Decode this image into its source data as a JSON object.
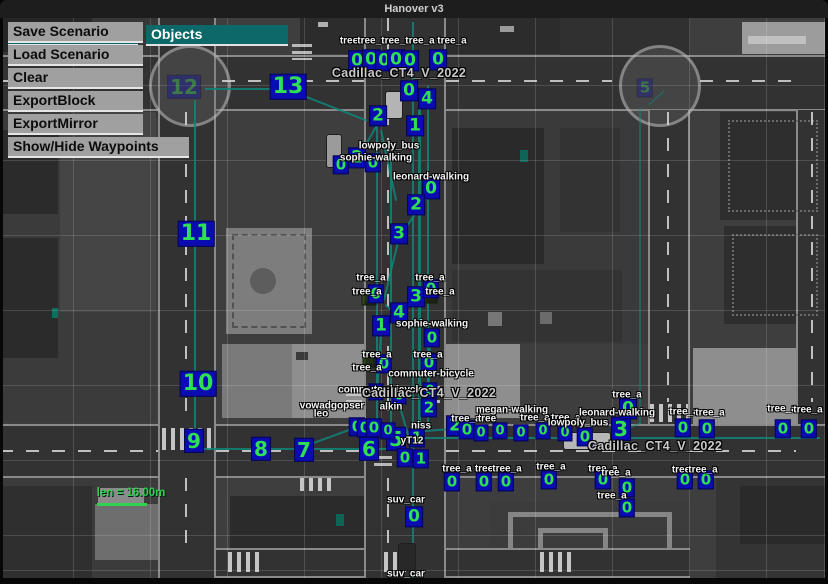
{
  "window": {
    "title": "Hanover v3"
  },
  "menu": {
    "file_label": "File",
    "objects_label": "Objects",
    "items": [
      "Save Scenario",
      "Load Scenario",
      "Clear",
      "ExportBlock",
      "ExportMirror",
      "Show/Hide Waypoints"
    ]
  },
  "hud": {
    "length_label": "len = 16.00m"
  },
  "colors": {
    "accent_teal": "#0d6969",
    "waypoint_green": "#2fe052",
    "waypoint_box_blue": "#0b0bb2",
    "path_teal": "#0f857a",
    "measure_green": "#2fd24f"
  },
  "map": {
    "waypoints": [
      [
        13,
        288,
        87,
        22
      ],
      [
        12,
        184,
        87,
        20,
        0.35
      ],
      [
        11,
        196,
        234,
        22
      ],
      [
        10,
        198,
        384,
        22
      ],
      [
        9,
        194,
        441,
        20
      ],
      [
        8,
        261,
        449,
        20
      ],
      [
        7,
        304,
        450,
        20
      ],
      [
        6,
        369,
        449,
        20
      ],
      [
        5,
        396,
        439,
        20
      ],
      [
        3,
        621,
        429,
        20
      ],
      [
        5,
        645,
        88,
        15,
        0.3
      ],
      [
        0,
        409,
        91,
        17
      ],
      [
        4,
        427,
        99,
        17
      ],
      [
        2,
        378,
        116,
        17
      ],
      [
        1,
        415,
        126,
        17
      ],
      [
        2,
        357,
        158,
        17
      ],
      [
        0,
        373,
        163,
        15
      ],
      [
        0,
        341,
        165,
        15
      ],
      [
        0,
        431,
        189,
        17
      ],
      [
        2,
        416,
        205,
        17
      ],
      [
        3,
        399,
        234,
        17
      ],
      [
        0,
        376,
        294,
        15
      ],
      [
        3,
        416,
        297,
        17
      ],
      [
        0,
        431,
        289,
        15
      ],
      [
        4,
        399,
        313,
        17
      ],
      [
        1,
        381,
        326,
        17
      ],
      [
        0,
        432,
        338,
        15
      ],
      [
        0,
        384,
        364,
        15
      ],
      [
        0,
        429,
        363,
        15
      ],
      [
        0,
        376,
        392,
        13
      ],
      [
        0,
        430,
        391,
        13
      ],
      [
        0,
        399,
        396,
        13
      ],
      [
        2,
        429,
        408,
        15
      ],
      [
        0,
        357,
        427,
        15
      ],
      [
        0,
        365,
        428,
        15
      ],
      [
        0,
        374,
        428,
        15
      ],
      [
        0,
        388,
        431,
        13
      ],
      [
        1,
        417,
        438,
        15
      ],
      [
        0,
        405,
        458,
        15
      ],
      [
        1,
        421,
        459,
        15
      ],
      [
        2,
        455,
        426,
        17
      ],
      [
        0,
        467,
        430,
        15
      ],
      [
        0,
        481,
        433,
        13
      ],
      [
        0,
        500,
        431,
        13
      ],
      [
        0,
        521,
        433,
        13
      ],
      [
        0,
        543,
        431,
        13
      ],
      [
        0,
        565,
        433,
        13
      ],
      [
        0,
        585,
        437,
        15
      ],
      [
        0,
        628,
        409,
        17
      ],
      [
        0,
        683,
        428,
        15
      ],
      [
        0,
        707,
        429,
        15
      ],
      [
        0,
        783,
        429,
        15
      ],
      [
        0,
        809,
        429,
        15
      ],
      [
        0,
        452,
        482,
        15
      ],
      [
        0,
        484,
        482,
        15
      ],
      [
        0,
        506,
        482,
        15
      ],
      [
        0,
        549,
        480,
        15
      ],
      [
        0,
        603,
        480,
        15
      ],
      [
        0,
        627,
        488,
        15
      ],
      [
        0,
        627,
        508,
        15
      ],
      [
        0,
        685,
        480,
        15
      ],
      [
        0,
        706,
        480,
        15
      ],
      [
        0,
        414,
        517,
        17
      ],
      [
        0,
        357,
        61,
        17
      ],
      [
        0,
        371,
        60,
        17
      ],
      [
        0,
        384,
        61,
        17
      ],
      [
        0,
        396,
        60,
        17
      ],
      [
        0,
        410,
        61,
        17
      ],
      [
        0,
        438,
        60,
        17
      ]
    ],
    "labels": [
      [
        "tree",
        349,
        41
      ],
      [
        "tree_a",
        372,
        41
      ],
      [
        "tree_a",
        396,
        41
      ],
      [
        "tree_a",
        420,
        41
      ],
      [
        "tree_a",
        452,
        41
      ],
      [
        "Cadillac_CT4_V_2022",
        399,
        73,
        "car"
      ],
      [
        "lowpoly_bus",
        389,
        146
      ],
      [
        "sophie-walking",
        376,
        158
      ],
      [
        "leonard-walking",
        431,
        177
      ],
      [
        "tree_a",
        371,
        278
      ],
      [
        "tree_a",
        430,
        278
      ],
      [
        "tree_a",
        367,
        292
      ],
      [
        "tree_a",
        440,
        292
      ],
      [
        "sophie-walking",
        432,
        324
      ],
      [
        "tree_a",
        377,
        355
      ],
      [
        "tree_a",
        428,
        355
      ],
      [
        "tree_a",
        367,
        368
      ],
      [
        "commuter-bicycle",
        431,
        374
      ],
      [
        "commuter-bicycle",
        381,
        390
      ],
      [
        "Cadillac_CT4_V_2022",
        429,
        393,
        "car"
      ],
      [
        "vowadgopser",
        332,
        406
      ],
      [
        "leo",
        321,
        414
      ],
      [
        "alkin",
        391,
        407
      ],
      [
        "niss",
        421,
        426
      ],
      [
        "yT12",
        412,
        441
      ],
      [
        "megan-walking",
        512,
        410
      ],
      [
        "tree_a",
        466,
        419
      ],
      [
        "tree",
        487,
        419
      ],
      [
        "tree_a",
        535,
        418
      ],
      [
        "tree_a",
        566,
        418
      ],
      [
        "tree_a",
        627,
        395
      ],
      [
        "leonard-walking",
        617,
        413
      ],
      [
        "lowpoly_bus",
        578,
        423
      ],
      [
        "tree_a",
        684,
        412
      ],
      [
        "tree_a",
        710,
        413
      ],
      [
        "tree_a",
        782,
        409
      ],
      [
        "tree_a",
        808,
        410
      ],
      [
        "Cadillac_CT4_V_2022",
        655,
        446,
        "car"
      ],
      [
        "tree_a",
        457,
        469
      ],
      [
        "tree",
        484,
        469
      ],
      [
        "tree_a",
        507,
        469
      ],
      [
        "tree_a",
        551,
        467
      ],
      [
        "tree_a",
        603,
        469
      ],
      [
        "tree_a",
        616,
        473
      ],
      [
        "tree_a",
        612,
        496
      ],
      [
        "tree",
        681,
        470
      ],
      [
        "tree_a",
        703,
        470
      ],
      [
        "suv_car",
        406,
        500
      ],
      [
        "suv_car",
        406,
        574
      ]
    ],
    "paths": [
      [
        196,
        100,
        196,
        446,
        2
      ],
      [
        205,
        88,
        281,
        88,
        2
      ],
      [
        294,
        91,
        368,
        120,
        2
      ],
      [
        378,
        110,
        378,
        428,
        2
      ],
      [
        392,
        152,
        392,
        430,
        2
      ],
      [
        414,
        22,
        414,
        578,
        2
      ],
      [
        421,
        96,
        421,
        428,
        3
      ],
      [
        429,
        86,
        429,
        424,
        2
      ],
      [
        200,
        448,
        392,
        448,
        2
      ],
      [
        398,
        437,
        820,
        437,
        2
      ],
      [
        641,
        108,
        641,
        424,
        2,
        0.5
      ],
      [
        641,
        424,
        622,
        432,
        2,
        0.5
      ],
      [
        648,
        104,
        664,
        90,
        2,
        0.4
      ],
      [
        380,
        122,
        358,
        160,
        2
      ],
      [
        382,
        130,
        397,
        200,
        2
      ],
      [
        430,
        194,
        400,
        238,
        2
      ],
      [
        399,
        242,
        385,
        300,
        2
      ],
      [
        386,
        304,
        399,
        316,
        2
      ],
      [
        382,
        332,
        378,
        392,
        2
      ],
      [
        431,
        344,
        429,
        404,
        2
      ],
      [
        399,
        400,
        414,
        452,
        2
      ],
      [
        352,
        430,
        300,
        449,
        2
      ],
      [
        398,
        432,
        452,
        428,
        2
      ]
    ],
    "trees": [
      [
        357,
        62
      ],
      [
        371,
        61
      ],
      [
        385,
        62
      ],
      [
        396,
        61
      ],
      [
        410,
        62
      ],
      [
        438,
        61
      ],
      [
        481,
        434
      ],
      [
        500,
        432
      ],
      [
        521,
        434
      ],
      [
        543,
        432
      ],
      [
        565,
        434
      ],
      [
        628,
        411
      ],
      [
        683,
        429
      ],
      [
        707,
        430
      ],
      [
        783,
        430
      ],
      [
        809,
        430
      ],
      [
        452,
        484
      ],
      [
        484,
        484
      ],
      [
        506,
        484
      ],
      [
        549,
        482
      ],
      [
        603,
        482
      ],
      [
        627,
        490
      ],
      [
        627,
        510
      ],
      [
        685,
        482
      ],
      [
        706,
        482
      ],
      [
        369,
        298
      ],
      [
        430,
        296
      ],
      [
        370,
        360
      ],
      [
        429,
        360
      ]
    ],
    "vehicles": [
      [
        393,
        104,
        16,
        26,
        "#b4b4b4"
      ],
      [
        333,
        150,
        14,
        32,
        "#9b9b9b"
      ],
      [
        586,
        440,
        46,
        16,
        "#b7b7b7"
      ],
      [
        406,
        556,
        16,
        26,
        "#282828"
      ]
    ]
  }
}
